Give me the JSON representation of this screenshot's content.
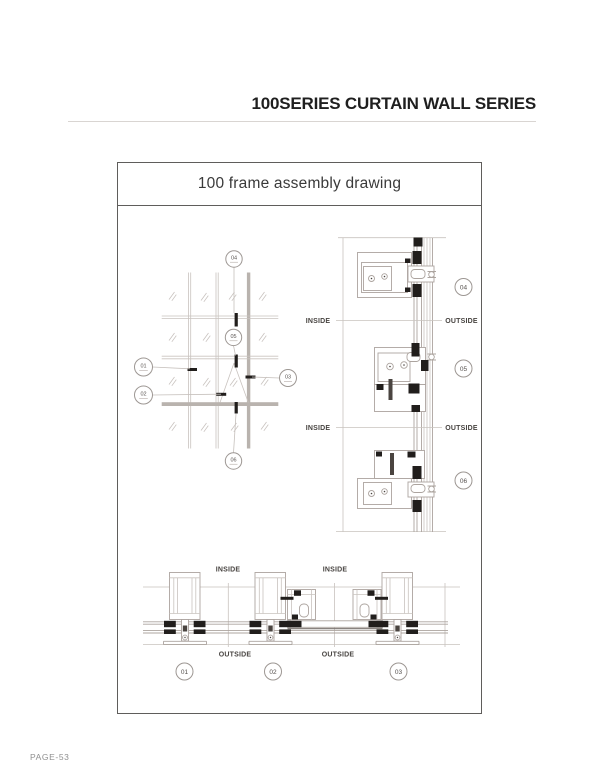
{
  "page": {
    "header_title": "100SERIES CURTAIN WALL SERIES",
    "footer_page": "PAGE-53"
  },
  "drawing": {
    "title": "100 frame assembly drawing",
    "labels": {
      "inside": "INSIDE",
      "outside": "OUTSIDE"
    },
    "callouts": {
      "n01": "01",
      "n02": "02",
      "n03": "03",
      "n04": "04",
      "n05": "05",
      "n06": "06"
    },
    "colors": {
      "line_light": "#c9c3bf",
      "line_detail": "#aca49f",
      "gasket_black": "#211e1c",
      "heavy_gray": "#b9b3ae",
      "circle_ring": "#9d9793",
      "label_text": "#474340"
    }
  }
}
